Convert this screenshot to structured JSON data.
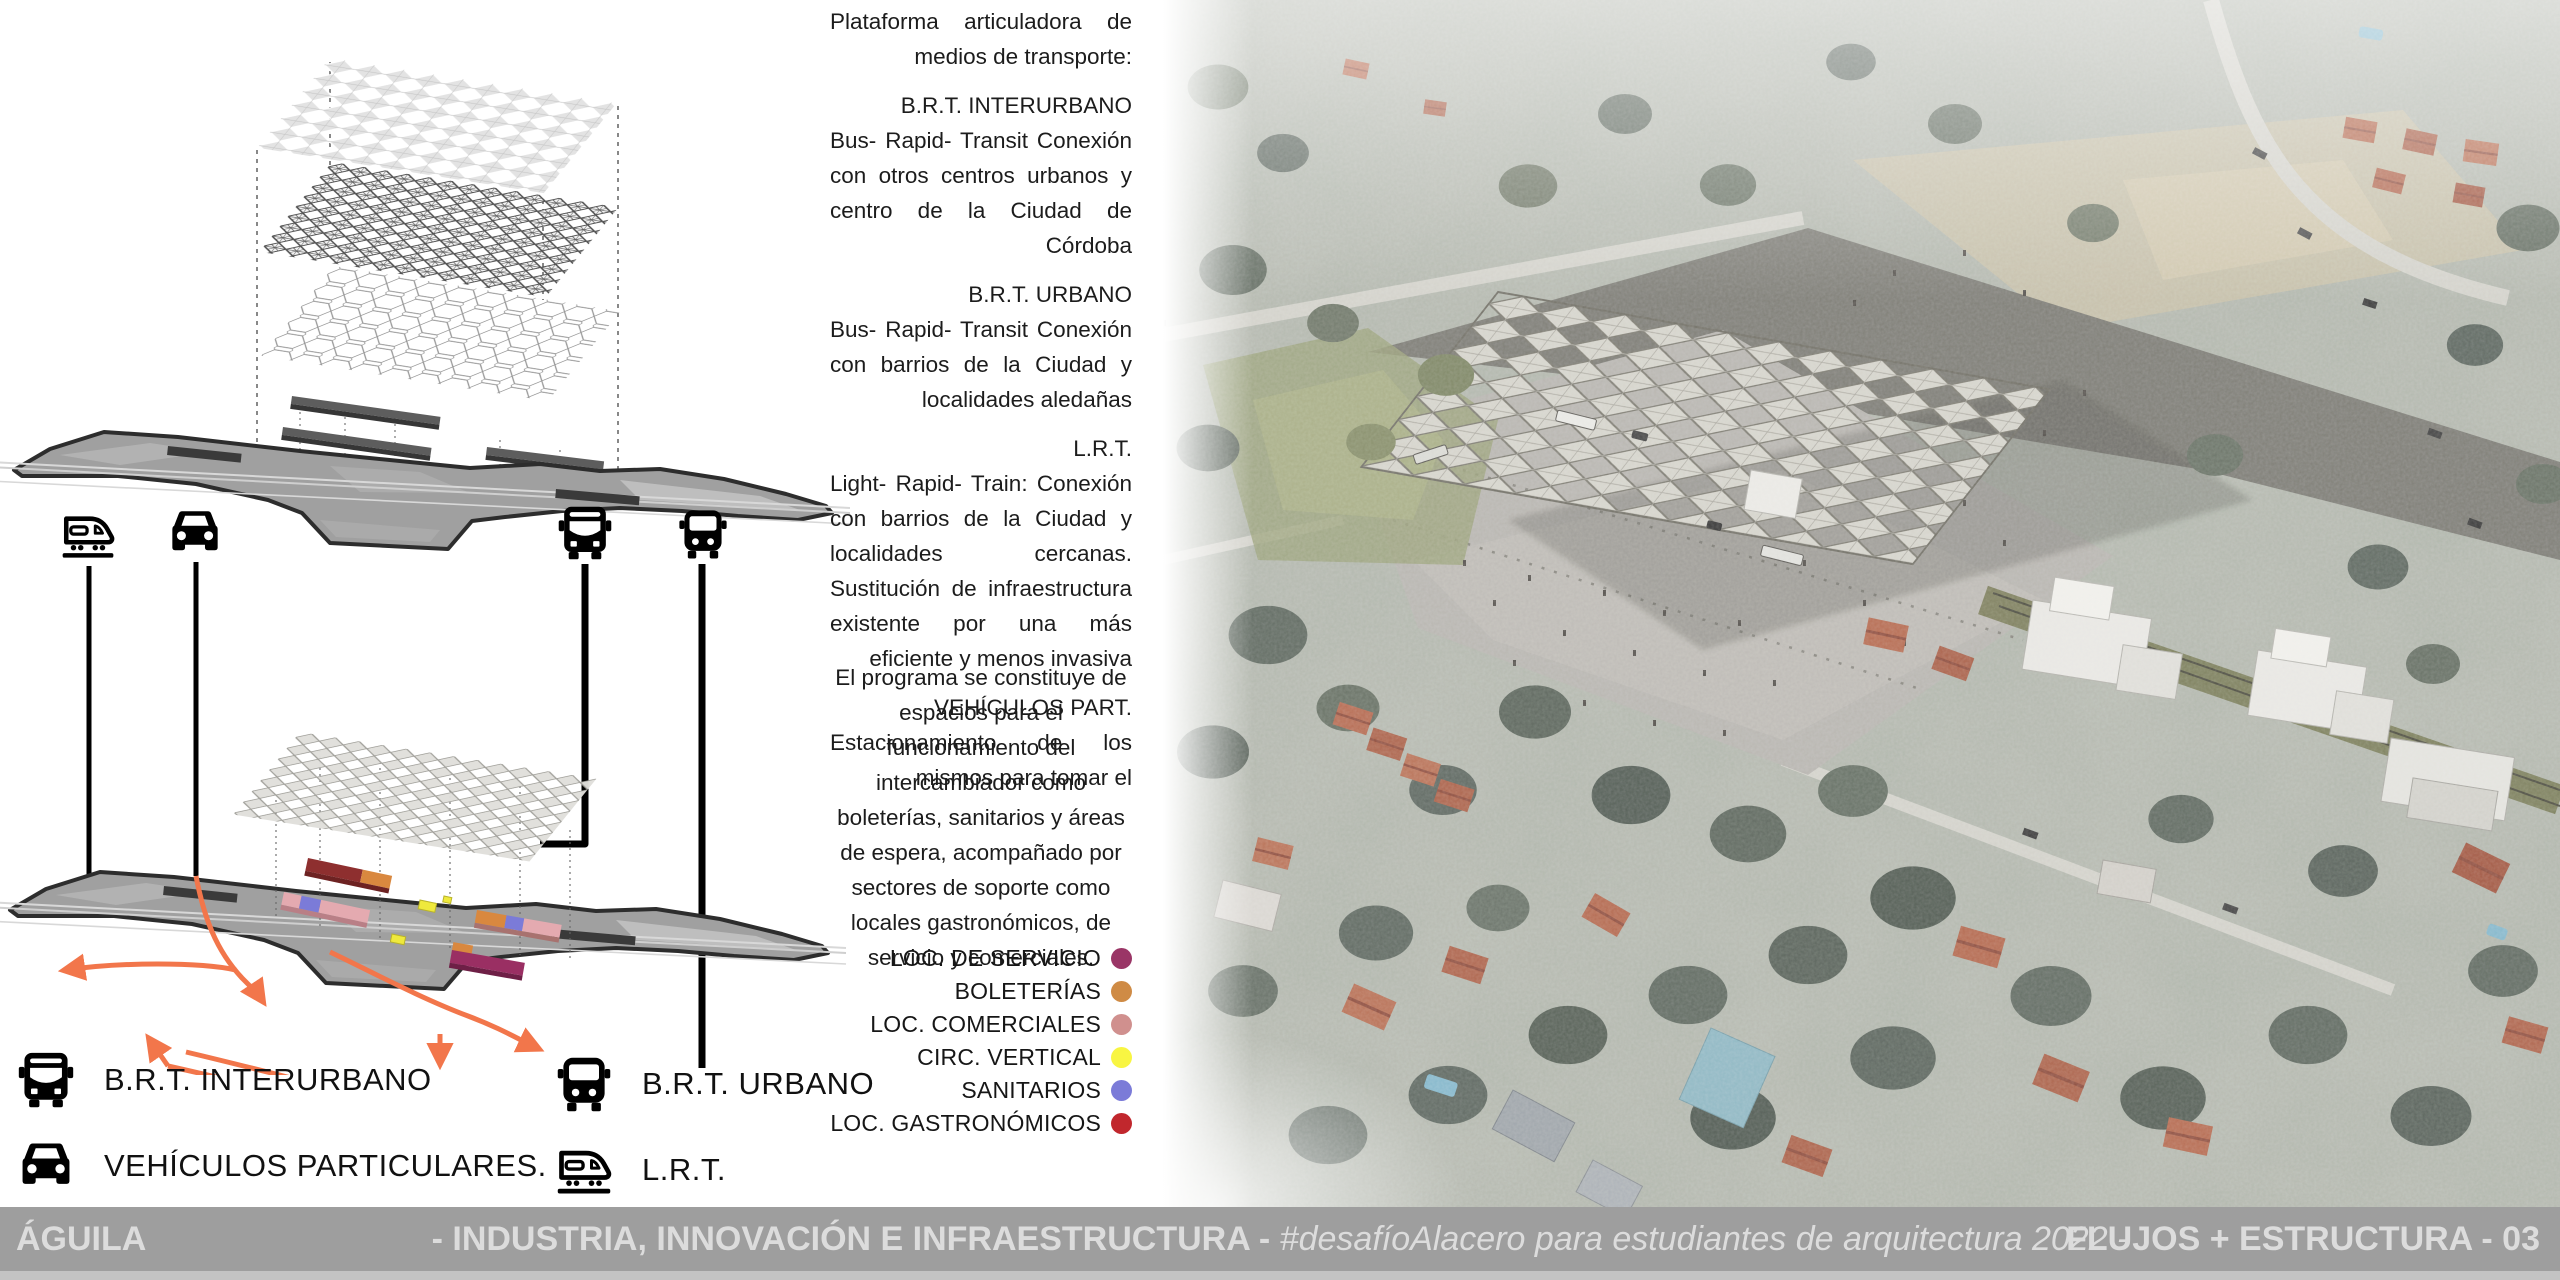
{
  "text_panel": {
    "intro": "Plataforma articuladora de medios de transporte:",
    "sections": [
      {
        "heading": "B.R.T. INTERURBANO",
        "body": "Bus- Rapid- Transit Conexión con otros centros urbanos y centro de la Ciudad de Córdoba"
      },
      {
        "heading": "B.R.T. URBANO",
        "body": "Bus- Rapid- Transit Conexión con barrios de la Ciudad y localidades aledañas"
      },
      {
        "heading": "L.R.T.",
        "body": "Light- Rapid- Train: Conexión con barrios de la Ciudad y localidades cercanas. Sustitución de infraestructura existente por una más eficiente y menos invasiva"
      },
      {
        "heading": "VEHÍCULOS PART.",
        "body": "Estacionamiento de los mismos para tomar el"
      }
    ],
    "program": "El programa se constituye de espacios para el funcionamiento del intercambiador como boleterías, sanitarios y áreas de espera, acompañado por sectores de soporte como locales gastronómicos, de servicio y comerciales."
  },
  "program_legend": {
    "items": [
      {
        "label": "LOC. DE SERVICIO",
        "color": "#9a3566"
      },
      {
        "label": "BOLETERÍAS",
        "color": "#cf8b45"
      },
      {
        "label": "LOC. COMERCIALES",
        "color": "#d0908e"
      },
      {
        "label": "CIRC. VERTICAL",
        "color": "#f8f542"
      },
      {
        "label": "SANITARIOS",
        "color": "#7b7bd8"
      },
      {
        "label": "LOC. GASTRONÓMICOS",
        "color": "#c1272d"
      }
    ]
  },
  "transport_legend": {
    "items": [
      {
        "icon": "coach-bus-icon",
        "label": "B.R.T. INTERURBANO"
      },
      {
        "icon": "city-bus-icon",
        "label": "B.R.T. URBANO"
      },
      {
        "icon": "car-icon",
        "label": "VEHÍCULOS PARTICULARES."
      },
      {
        "icon": "lrt-icon",
        "label": "L.R.T."
      }
    ]
  },
  "footer": {
    "author": "ÁGUILA",
    "center_bold": "- INDUSTRIA, INNOVACIÓN E INFRAESTRUCTURA - ",
    "center_italic": "#desafíoAlacero para estudiantes de arquitectura 2022 -",
    "right": "FLUJOS + ESTRUCTURA - 03",
    "bar_color": "#9e9e9e",
    "text_color": "#dcdcdc"
  },
  "diagram_colors": {
    "flow_orange": "#f2764b",
    "plan_gray": "#a0a0a0",
    "plan_outline": "#2d2d2d"
  }
}
